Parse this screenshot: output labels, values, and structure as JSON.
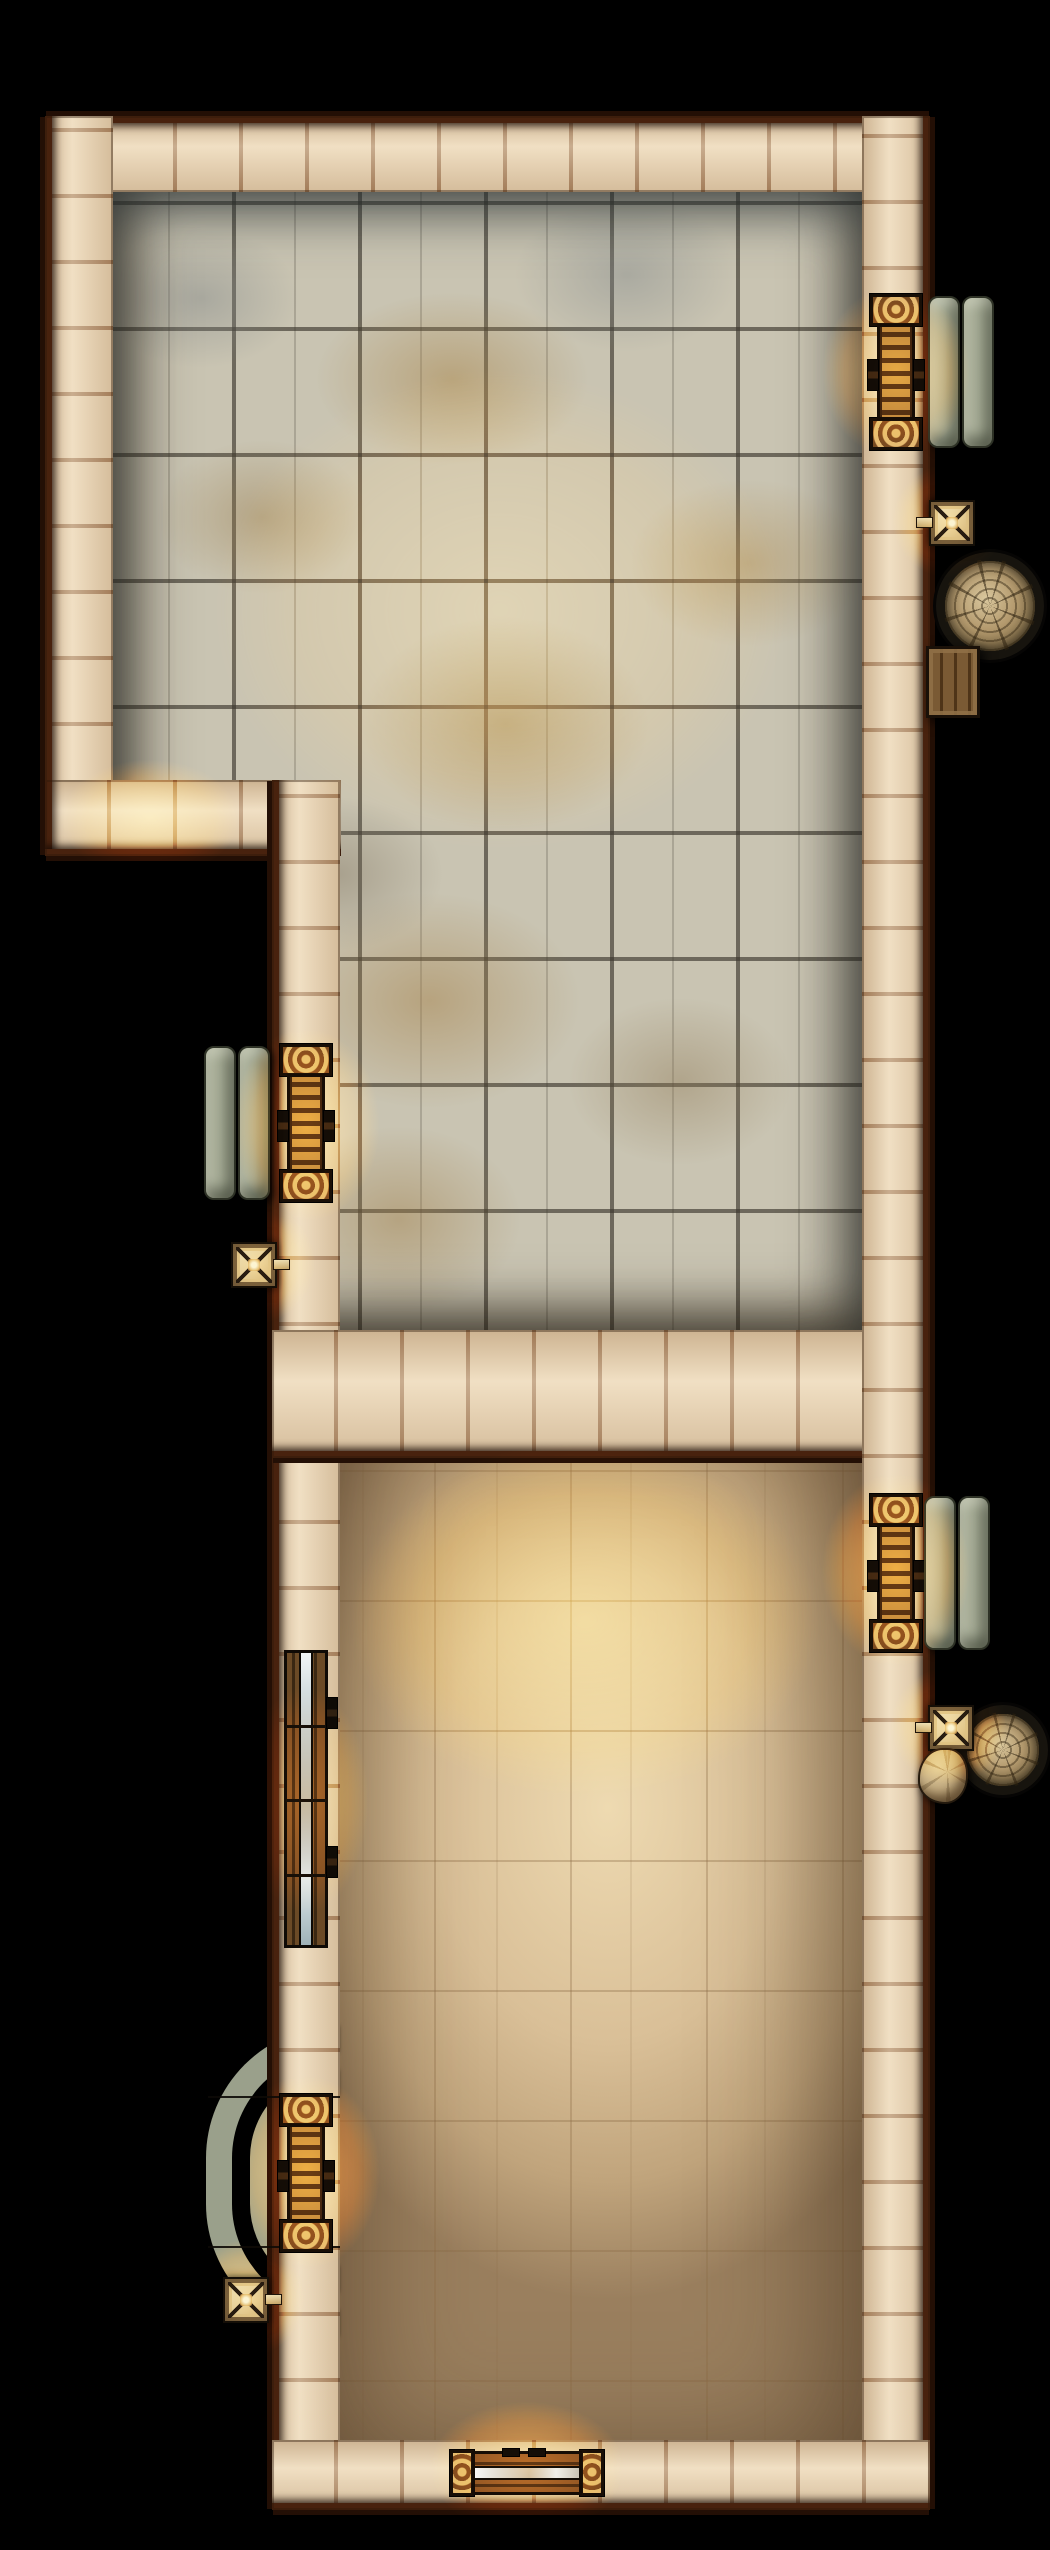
{
  "app": {
    "type": "vtt-battlemap-render",
    "title": "Walled stone hall battlemap, top-down"
  },
  "canvas": {
    "width": 1050,
    "height": 2550,
    "background": "#000000"
  },
  "palette": {
    "wall_block": "#e9d4b4",
    "wall_seam": "#7a4620",
    "wall_edge": "#48220e",
    "wall_edge_dark": "#230f05",
    "tile_base": "#c9c4b2",
    "tile_tan": "#b3945f",
    "tile_grout": "#59534a",
    "sand_light": "#eedab1",
    "sand_mid": "#d9bf97",
    "sand_dark": "#9a7f5e",
    "slab_light": "#c6cbb4",
    "slab": "#9aa08b",
    "slab_dark": "#6f7562",
    "slab_edge": "#2e3226",
    "wood_light": "#97713f",
    "wood": "#6b4a26",
    "wood_dark": "#3a2712",
    "cap_base": "#ad834f",
    "metal_light": "#d9d3b9",
    "metal": "#938b72",
    "rope_light": "#d9c79d",
    "rope": "#b49a6e",
    "rope_dark": "#5f4f34",
    "glow": "#ffcd82"
  },
  "floors": [
    {
      "id": "stone-room-floor",
      "type": "stone-tile",
      "x": 110,
      "y": 183,
      "w": 760,
      "h": 1152,
      "clip": [
        [
          0,
          0
        ],
        [
          760,
          0
        ],
        [
          760,
          1152
        ],
        [
          228,
          1152
        ],
        [
          228,
          599
        ],
        [
          0,
          599
        ]
      ]
    },
    {
      "id": "sand-room-floor",
      "type": "sand",
      "x": 300,
      "y": 1340,
      "w": 580,
      "h": 1170
    }
  ],
  "walls": [
    {
      "id": "wall-top",
      "orient": "h",
      "x": 45,
      "y": 116,
      "w": 885,
      "h": 76,
      "outer": [
        "top"
      ]
    },
    {
      "id": "wall-left-upper",
      "orient": "v",
      "x": 45,
      "y": 116,
      "w": 68,
      "h": 672,
      "outer": [
        "left"
      ]
    },
    {
      "id": "wall-step",
      "orient": "h",
      "x": 45,
      "y": 780,
      "w": 296,
      "h": 76,
      "outer": [
        "bottom",
        "left"
      ]
    },
    {
      "id": "wall-left-lower",
      "orient": "v",
      "x": 272,
      "y": 780,
      "w": 68,
      "h": 1730,
      "outer": [
        "left"
      ]
    },
    {
      "id": "wall-divider",
      "orient": "h",
      "x": 272,
      "y": 1330,
      "w": 658,
      "h": 128,
      "outer": [
        "bottom"
      ]
    },
    {
      "id": "wall-right",
      "orient": "v",
      "x": 862,
      "y": 116,
      "w": 68,
      "h": 2394,
      "outer": [
        "right"
      ]
    },
    {
      "id": "wall-bottom",
      "orient": "h",
      "x": 272,
      "y": 2440,
      "w": 658,
      "h": 70,
      "outer": [
        "bottom"
      ]
    }
  ],
  "doors": [
    {
      "id": "door-top-right",
      "style": "ladder",
      "orient": "v",
      "x": 860,
      "y": 294,
      "w": 72,
      "h": 156,
      "caps": true
    },
    {
      "id": "door-mid-left",
      "style": "ladder",
      "orient": "v",
      "x": 270,
      "y": 1044,
      "w": 72,
      "h": 158,
      "caps": true
    },
    {
      "id": "door-mid-right",
      "style": "ladder",
      "orient": "v",
      "x": 860,
      "y": 1494,
      "w": 72,
      "h": 158,
      "caps": true
    },
    {
      "id": "door-long-left",
      "style": "double",
      "orient": "v",
      "x": 272,
      "y": 1650,
      "w": 68,
      "h": 298,
      "caps": false
    },
    {
      "id": "door-bottom-left",
      "style": "ladder",
      "orient": "v",
      "x": 270,
      "y": 2094,
      "w": 72,
      "h": 158,
      "caps": true
    },
    {
      "id": "door-bottom-main",
      "style": "double",
      "orient": "h",
      "x": 450,
      "y": 2448,
      "w": 154,
      "h": 50,
      "caps": true
    }
  ],
  "furniture": {
    "benches": [
      {
        "id": "bench-top-right",
        "x": 928,
        "y": 296,
        "w": 64,
        "h": 152
      },
      {
        "id": "bench-mid-left",
        "x": 204,
        "y": 1046,
        "w": 64,
        "h": 154
      },
      {
        "id": "bench-mid-right",
        "x": 924,
        "y": 1496,
        "w": 64,
        "h": 154
      }
    ],
    "sconces": [
      {
        "id": "sconce-right-upper",
        "x": 929,
        "y": 500,
        "stem": "left"
      },
      {
        "id": "sconce-left-middle",
        "x": 231,
        "y": 1242,
        "stem": "right"
      },
      {
        "id": "sconce-right-lower",
        "x": 928,
        "y": 1705,
        "stem": "left"
      },
      {
        "id": "sconce-bottom-left",
        "x": 223,
        "y": 2277,
        "stem": "right"
      }
    ],
    "coils": [
      {
        "id": "rope-coil-large",
        "x": 936,
        "y": 552,
        "d": 90
      },
      {
        "id": "rope-coil-small",
        "x": 958,
        "y": 1705,
        "d": 72
      }
    ],
    "crates": [
      {
        "id": "wooden-crate",
        "x": 926,
        "y": 646,
        "w": 48,
        "h": 66
      }
    ],
    "sacks": [
      {
        "id": "supply-sack",
        "x": 918,
        "y": 1748,
        "w": 46,
        "h": 52
      }
    ]
  },
  "porch": {
    "id": "curved-porch-bench",
    "bands": [
      {
        "x": 206,
        "y": 2026,
        "w": 132,
        "h": 310,
        "b": 26,
        "r": 160
      },
      {
        "x": 250,
        "y": 2070,
        "w": 88,
        "h": 222,
        "b": 26,
        "r": 120
      }
    ],
    "swing_lines": [
      {
        "x": 208,
        "y": 2096,
        "w": 132
      },
      {
        "x": 208,
        "y": 2246,
        "w": 132
      }
    ]
  },
  "lights": [
    {
      "id": "glow-door-top-right",
      "cx": 896,
      "cy": 372,
      "rx": 95,
      "ry": 110,
      "o": 0.9
    },
    {
      "id": "glow-sconce-right-upper",
      "cx": 948,
      "cy": 521,
      "rx": 72,
      "ry": 72,
      "o": 1
    },
    {
      "id": "glow-step-corner",
      "cx": 150,
      "cy": 818,
      "rx": 115,
      "ry": 75,
      "o": 0.9
    },
    {
      "id": "glow-door-mid-left",
      "cx": 306,
      "cy": 1125,
      "rx": 95,
      "ry": 125,
      "o": 1
    },
    {
      "id": "glow-sconce-left",
      "cx": 255,
      "cy": 1263,
      "rx": 78,
      "ry": 78,
      "o": 1
    },
    {
      "id": "glow-door-mid-right",
      "cx": 896,
      "cy": 1570,
      "rx": 95,
      "ry": 125,
      "o": 1
    },
    {
      "id": "glow-sconce-right-lower",
      "cx": 948,
      "cy": 1726,
      "rx": 75,
      "ry": 75,
      "o": 1
    },
    {
      "id": "glow-door-long-left",
      "cx": 306,
      "cy": 1800,
      "rx": 80,
      "ry": 145,
      "o": 0.7
    },
    {
      "id": "glow-door-bottom-left",
      "cx": 306,
      "cy": 2172,
      "rx": 95,
      "ry": 125,
      "o": 1
    },
    {
      "id": "glow-sconce-bottom-left",
      "cx": 247,
      "cy": 2298,
      "rx": 75,
      "ry": 75,
      "o": 1
    },
    {
      "id": "glow-door-bottom-main",
      "cx": 527,
      "cy": 2468,
      "rx": 125,
      "ry": 85,
      "o": 0.9
    },
    {
      "id": "glow-sand-ambient",
      "cx": 585,
      "cy": 1620,
      "rx": 300,
      "ry": 230,
      "o": 0.75
    },
    {
      "id": "glow-stone-ambient",
      "cx": 500,
      "cy": 610,
      "rx": 370,
      "ry": 310,
      "o": 0.5
    }
  ]
}
